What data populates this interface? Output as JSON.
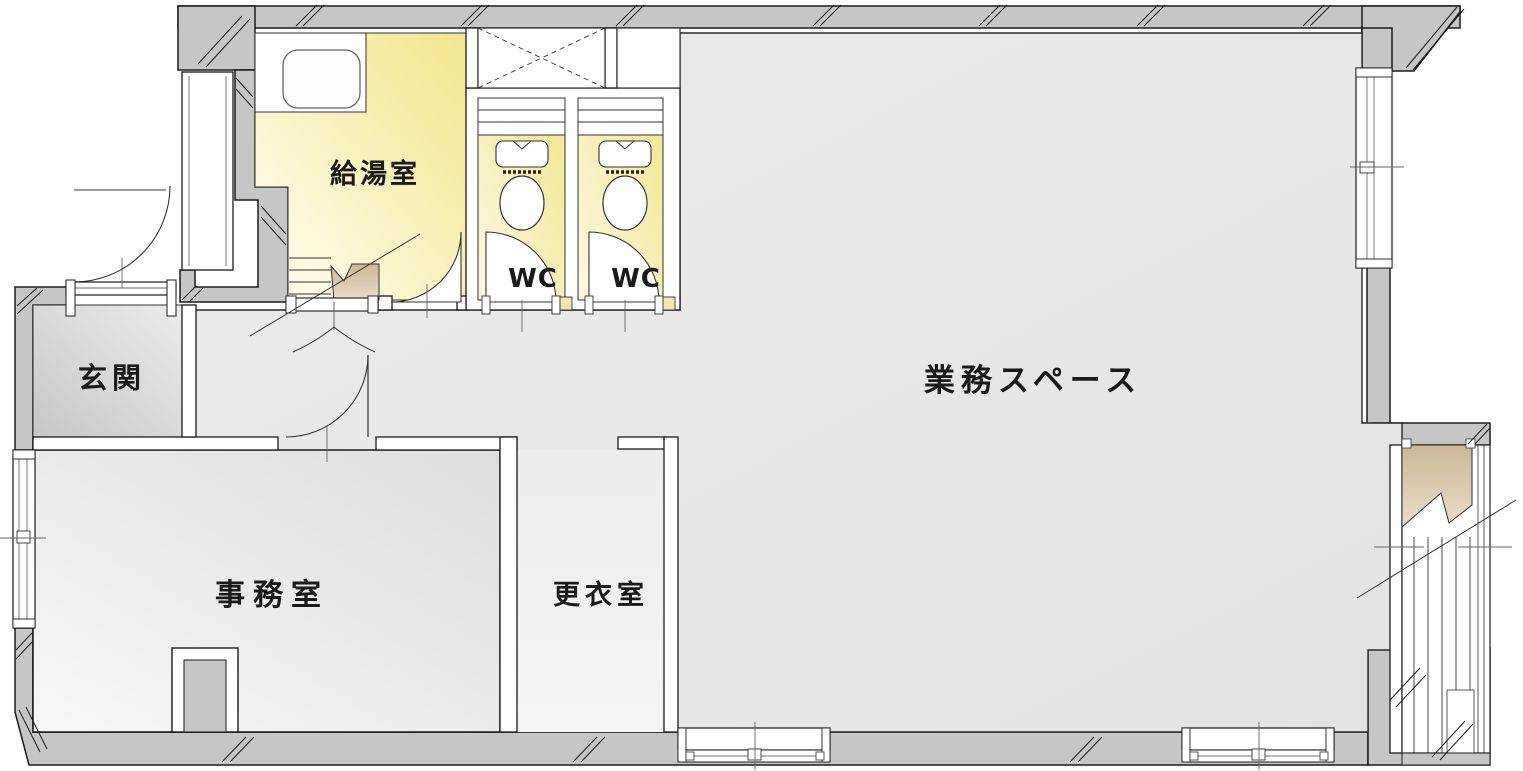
{
  "plan": {
    "type": "floor-plan",
    "language": "ja",
    "rooms": [
      {
        "id": "kitchenette",
        "label": "給湯室"
      },
      {
        "id": "wc-1",
        "label": "WC"
      },
      {
        "id": "wc-2",
        "label": "WC"
      },
      {
        "id": "entrance-hall",
        "label": "玄関"
      },
      {
        "id": "work-space",
        "label": "業務スペース"
      },
      {
        "id": "office",
        "label": "事務室"
      },
      {
        "id": "changing-room",
        "label": "更衣室"
      }
    ],
    "fixtures": [
      "kitchen-counter-with-sink",
      "toilet",
      "toilet",
      "duct-shaft-cross-box",
      "wc-shelf",
      "wc-shelf",
      "entrance-steps",
      "stair-break-landing",
      "exterior-staircase",
      "swing-doors",
      "double-swing-door",
      "sliding-windows"
    ],
    "colors": {
      "wall_fill": "#c6c6c6",
      "wall_edge": "#1b1b1b",
      "floor_light": "#f0f0f0",
      "floor_dark": "#e2e2e2",
      "room_yellow": "#f3e68c",
      "room_yellow_light": "#fffdf2",
      "entrance_gray_dark": "#c7c7c7",
      "office_gray": "#dedede",
      "stair_tan": "#d6c3a4",
      "label_color": "#1a1a1a"
    }
  }
}
